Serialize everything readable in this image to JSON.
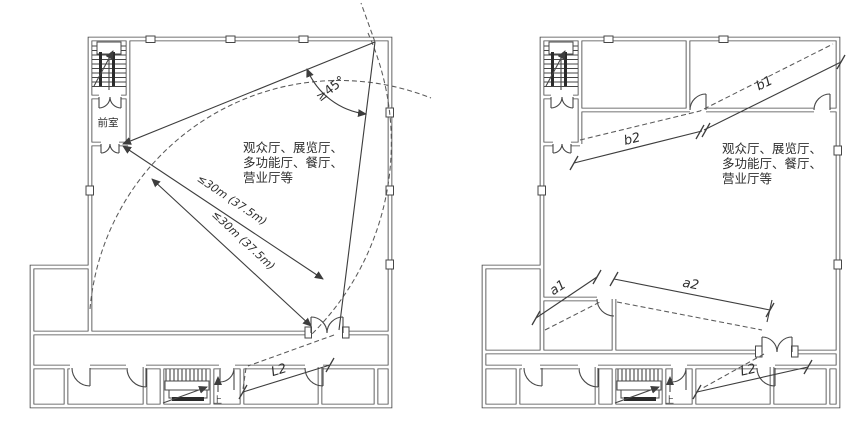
{
  "colors": {
    "background": "#ffffff",
    "line": "#474747",
    "text": "#2e2e2e"
  },
  "left_plan": {
    "vestibule_label": "前室",
    "hall_label_lines": [
      "观众厅、展览厅、",
      "多功能厅、餐厅、",
      "营业厅等"
    ],
    "angle_label": "≥45°",
    "distance_labels": [
      "≤30m (37.5m)",
      "≤30m (37.5m)"
    ],
    "corridor_dim_label": "L2",
    "stair_up_label": "上"
  },
  "right_plan": {
    "hall_label_lines": [
      "观众厅、展览厅、",
      "多功能厅、餐厅、",
      "营业厅等"
    ],
    "dim_labels": {
      "b1": "b1",
      "b2": "b2",
      "a1": "a1",
      "a2": "a2",
      "l2": "L2"
    },
    "stair_up_label": "上"
  }
}
